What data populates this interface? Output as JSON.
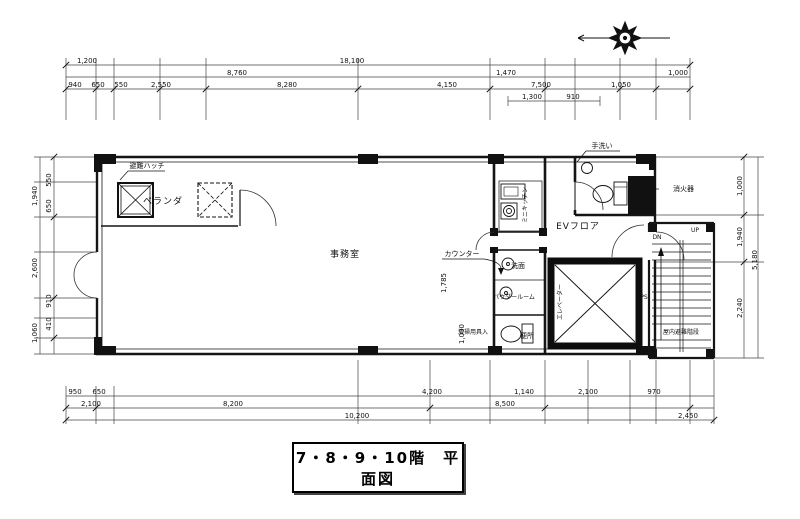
{
  "title": "7・8・9・10階　平面図",
  "rooms": {
    "office": "事務室",
    "ev_floor": "EVフロア",
    "veranda": "ベランダ",
    "mini_kitchen": "ミニキッチン",
    "washbasin": "洗面",
    "powder_room": "パウダールーム",
    "toilet": "便所",
    "hand_wash": "手洗い",
    "elevator": "エレベーター",
    "pipe_space": "PS",
    "indoor_stairs": "屋内避難階段",
    "down": "DN",
    "up": "UP"
  },
  "annotations": {
    "escape_hatch": "避難ハッチ",
    "fire_extinguisher": "消火器",
    "counter": "カウンター",
    "cleaning_closet": "清掃用具入"
  },
  "dimensions": {
    "top_row1": [
      "1,200",
      "18,100"
    ],
    "top_row2": [
      "8,760",
      "1,470",
      "1,000"
    ],
    "top_row3": [
      "940",
      "650",
      "550",
      "2,550",
      "8,280",
      "4,150",
      "7,500",
      "1,050"
    ],
    "top_row4": [
      "1,300",
      "910"
    ],
    "bottom_row1": [
      "950",
      "650",
      "4,200",
      "1,140",
      "2,100",
      "970"
    ],
    "bottom_row2": [
      "2,100",
      "8,200",
      "8,500"
    ],
    "bottom_row3": [
      "10,200",
      "2,450"
    ],
    "left": [
      "550",
      "650",
      "1,940",
      "2,600",
      "910",
      "410",
      "1,060"
    ],
    "right": [
      "1,000",
      "1,940",
      "2,240",
      "5,180"
    ],
    "interior": [
      "1,785",
      "1,000"
    ]
  }
}
